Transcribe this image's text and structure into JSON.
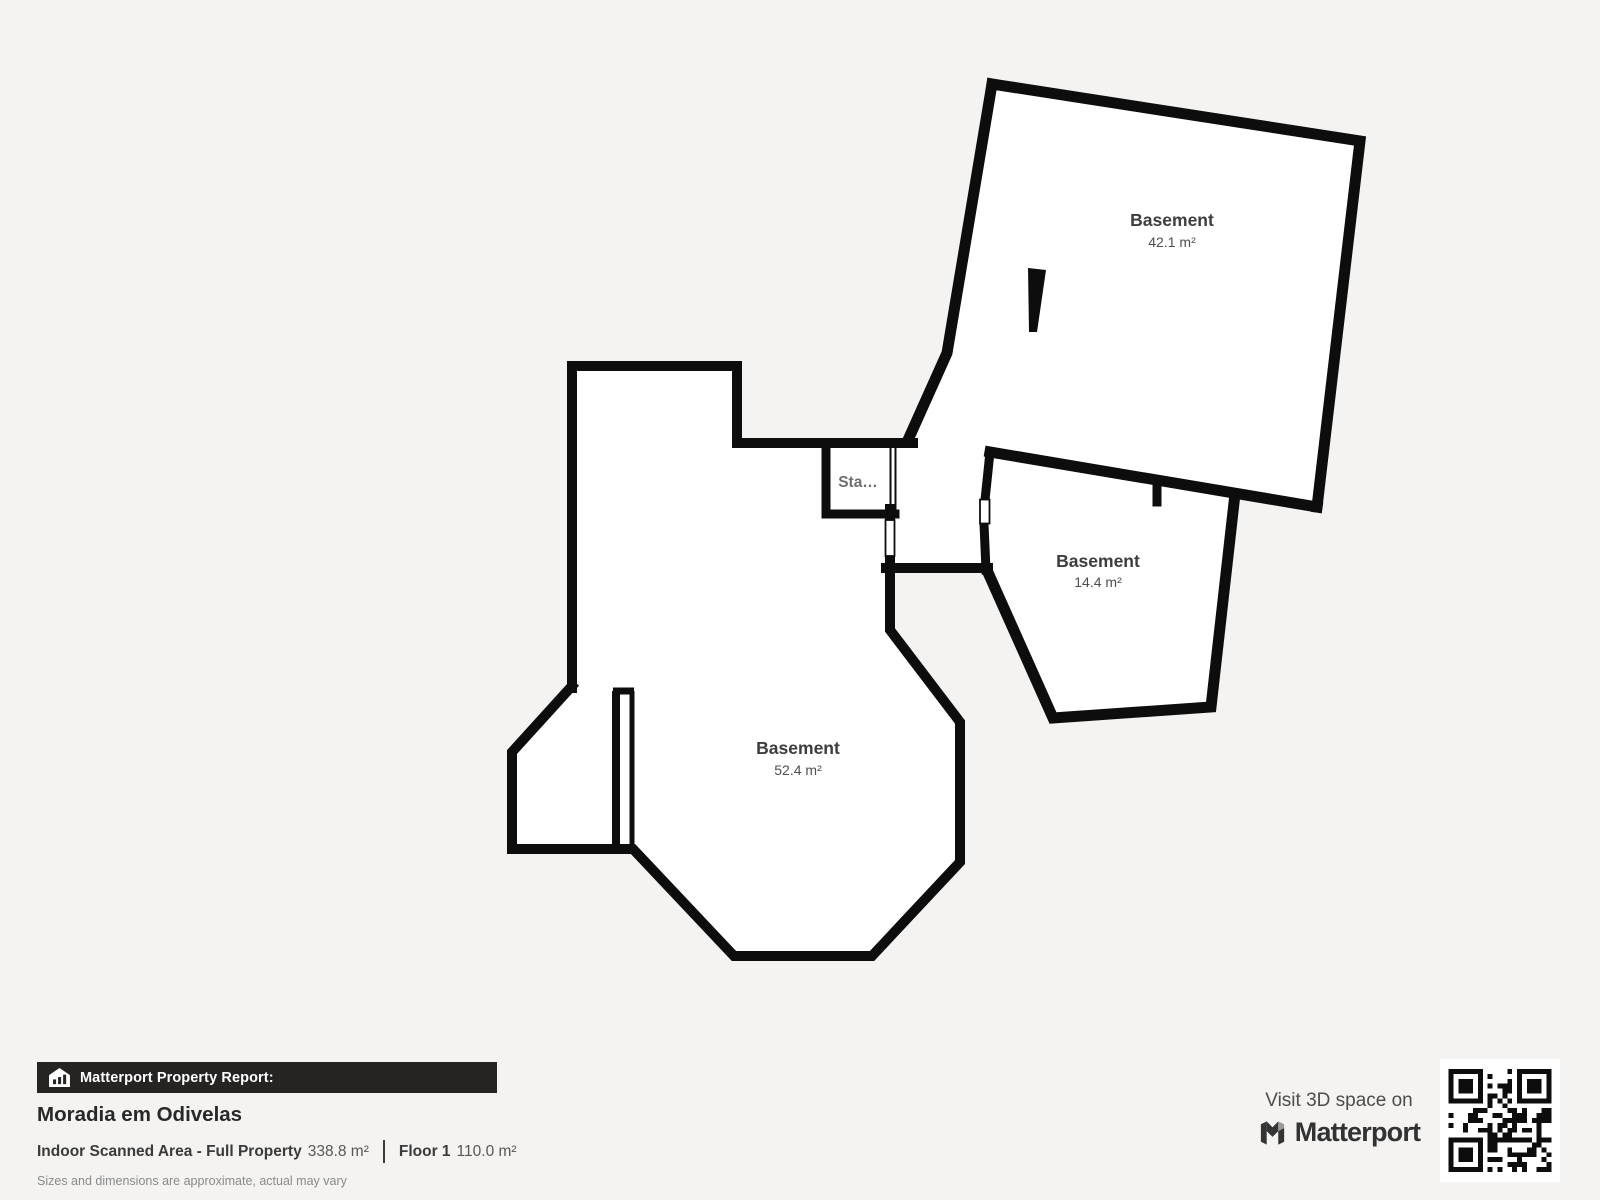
{
  "floorplan": {
    "rooms": [
      {
        "name": "Basement",
        "area": "42.1 m²"
      },
      {
        "name": "Basement",
        "area": "14.4 m²"
      },
      {
        "name": "Basement",
        "area": "52.4 m²"
      }
    ],
    "stairs_label": "Sta…",
    "colors": {
      "wall": "#0d0d0d",
      "room_fill": "#ffffff",
      "background": "#f4f3f1"
    }
  },
  "footer": {
    "report_label": "Matterport Property Report:",
    "property_name": "Moradia em Odivelas",
    "scanned_area_label": "Indoor Scanned Area - Full Property",
    "scanned_area_value": "338.8 m²",
    "floor_label": "Floor 1",
    "floor_value": "110.0 m²",
    "disclaimer": "Sizes and dimensions are approximate, actual may vary"
  },
  "badge": {
    "visit_text": "Visit 3D space on",
    "brand": "Matterport"
  }
}
